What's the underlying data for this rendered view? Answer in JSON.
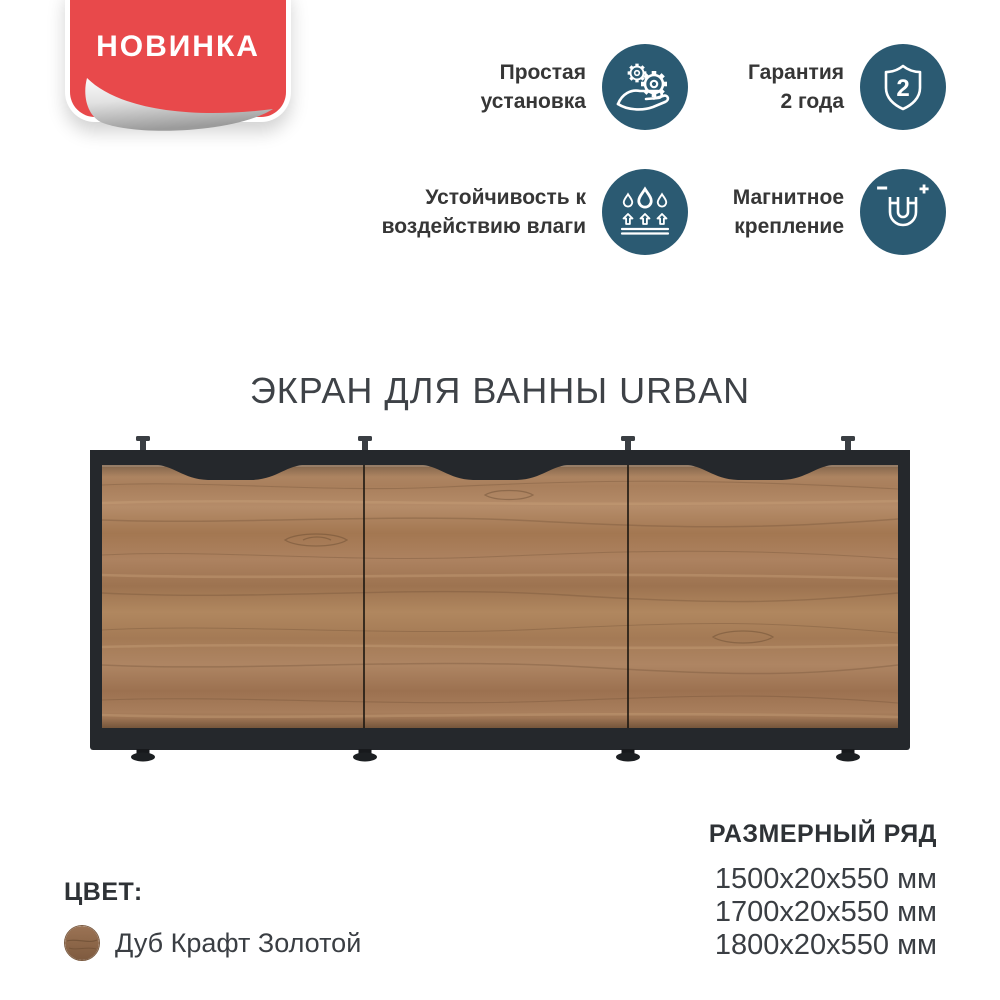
{
  "badge": {
    "label": "НОВИНКА"
  },
  "title": "ЭКРАН ДЛЯ ВАННЫ URBAN",
  "features": [
    {
      "icon": "hand-gears-icon",
      "line1": "Простая",
      "line2": "установка"
    },
    {
      "icon": "shield-2-icon",
      "line1": "Гарантия",
      "line2": "2 года",
      "shield_number": "2"
    },
    {
      "icon": "water-drops-icon",
      "line1": "Устойчивость к",
      "line2": "воздействию влаги"
    },
    {
      "icon": "magnet-icon",
      "line1": "Магнитное",
      "line2": "крепление",
      "minus_sign": "−",
      "plus_sign": "+"
    }
  ],
  "color_section": {
    "heading": "ЦВЕТ:",
    "swatch_label": "Дуб Крафт Золотой"
  },
  "size_section": {
    "heading": "РАЗМЕРНЫЙ РЯД",
    "sizes": [
      "1500x20x550 мм",
      "1700x20x550 мм",
      "1800x20x550 мм"
    ]
  },
  "colors": {
    "badge_red": "#e8494b",
    "icon_circle_teal": "#2b5a72",
    "frame_dark": "#25282c",
    "wood_base": "#a87c5b",
    "text_dark": "#363636",
    "text_light": "#3e4247"
  }
}
